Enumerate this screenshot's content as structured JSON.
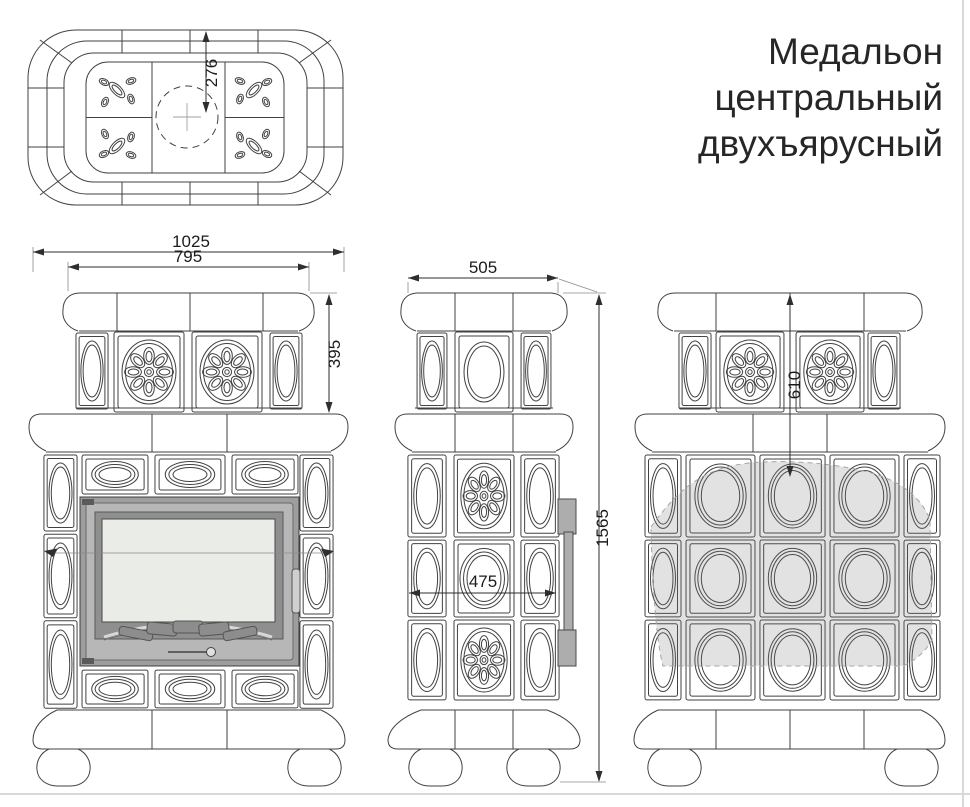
{
  "title": {
    "lines": [
      "Медальон",
      "центральный",
      "двухъярусный"
    ]
  },
  "dimensions": {
    "top_depth_to_center": "276",
    "front_total_width": "1025",
    "front_upper_width": "795",
    "front_upper_tier_height": "395",
    "side_top_depth": "505",
    "side_body_depth": "475",
    "total_height": "1565",
    "back_upper_drop": "610"
  },
  "colors": {
    "line": "#424242",
    "door_rim": "#9e9e9e",
    "door_face": "#b7b7b7",
    "door_bezel": "#8f8f8f",
    "glass": "#eaece7",
    "vent": "#8d8d8d",
    "shade": "#c9c9c9"
  }
}
